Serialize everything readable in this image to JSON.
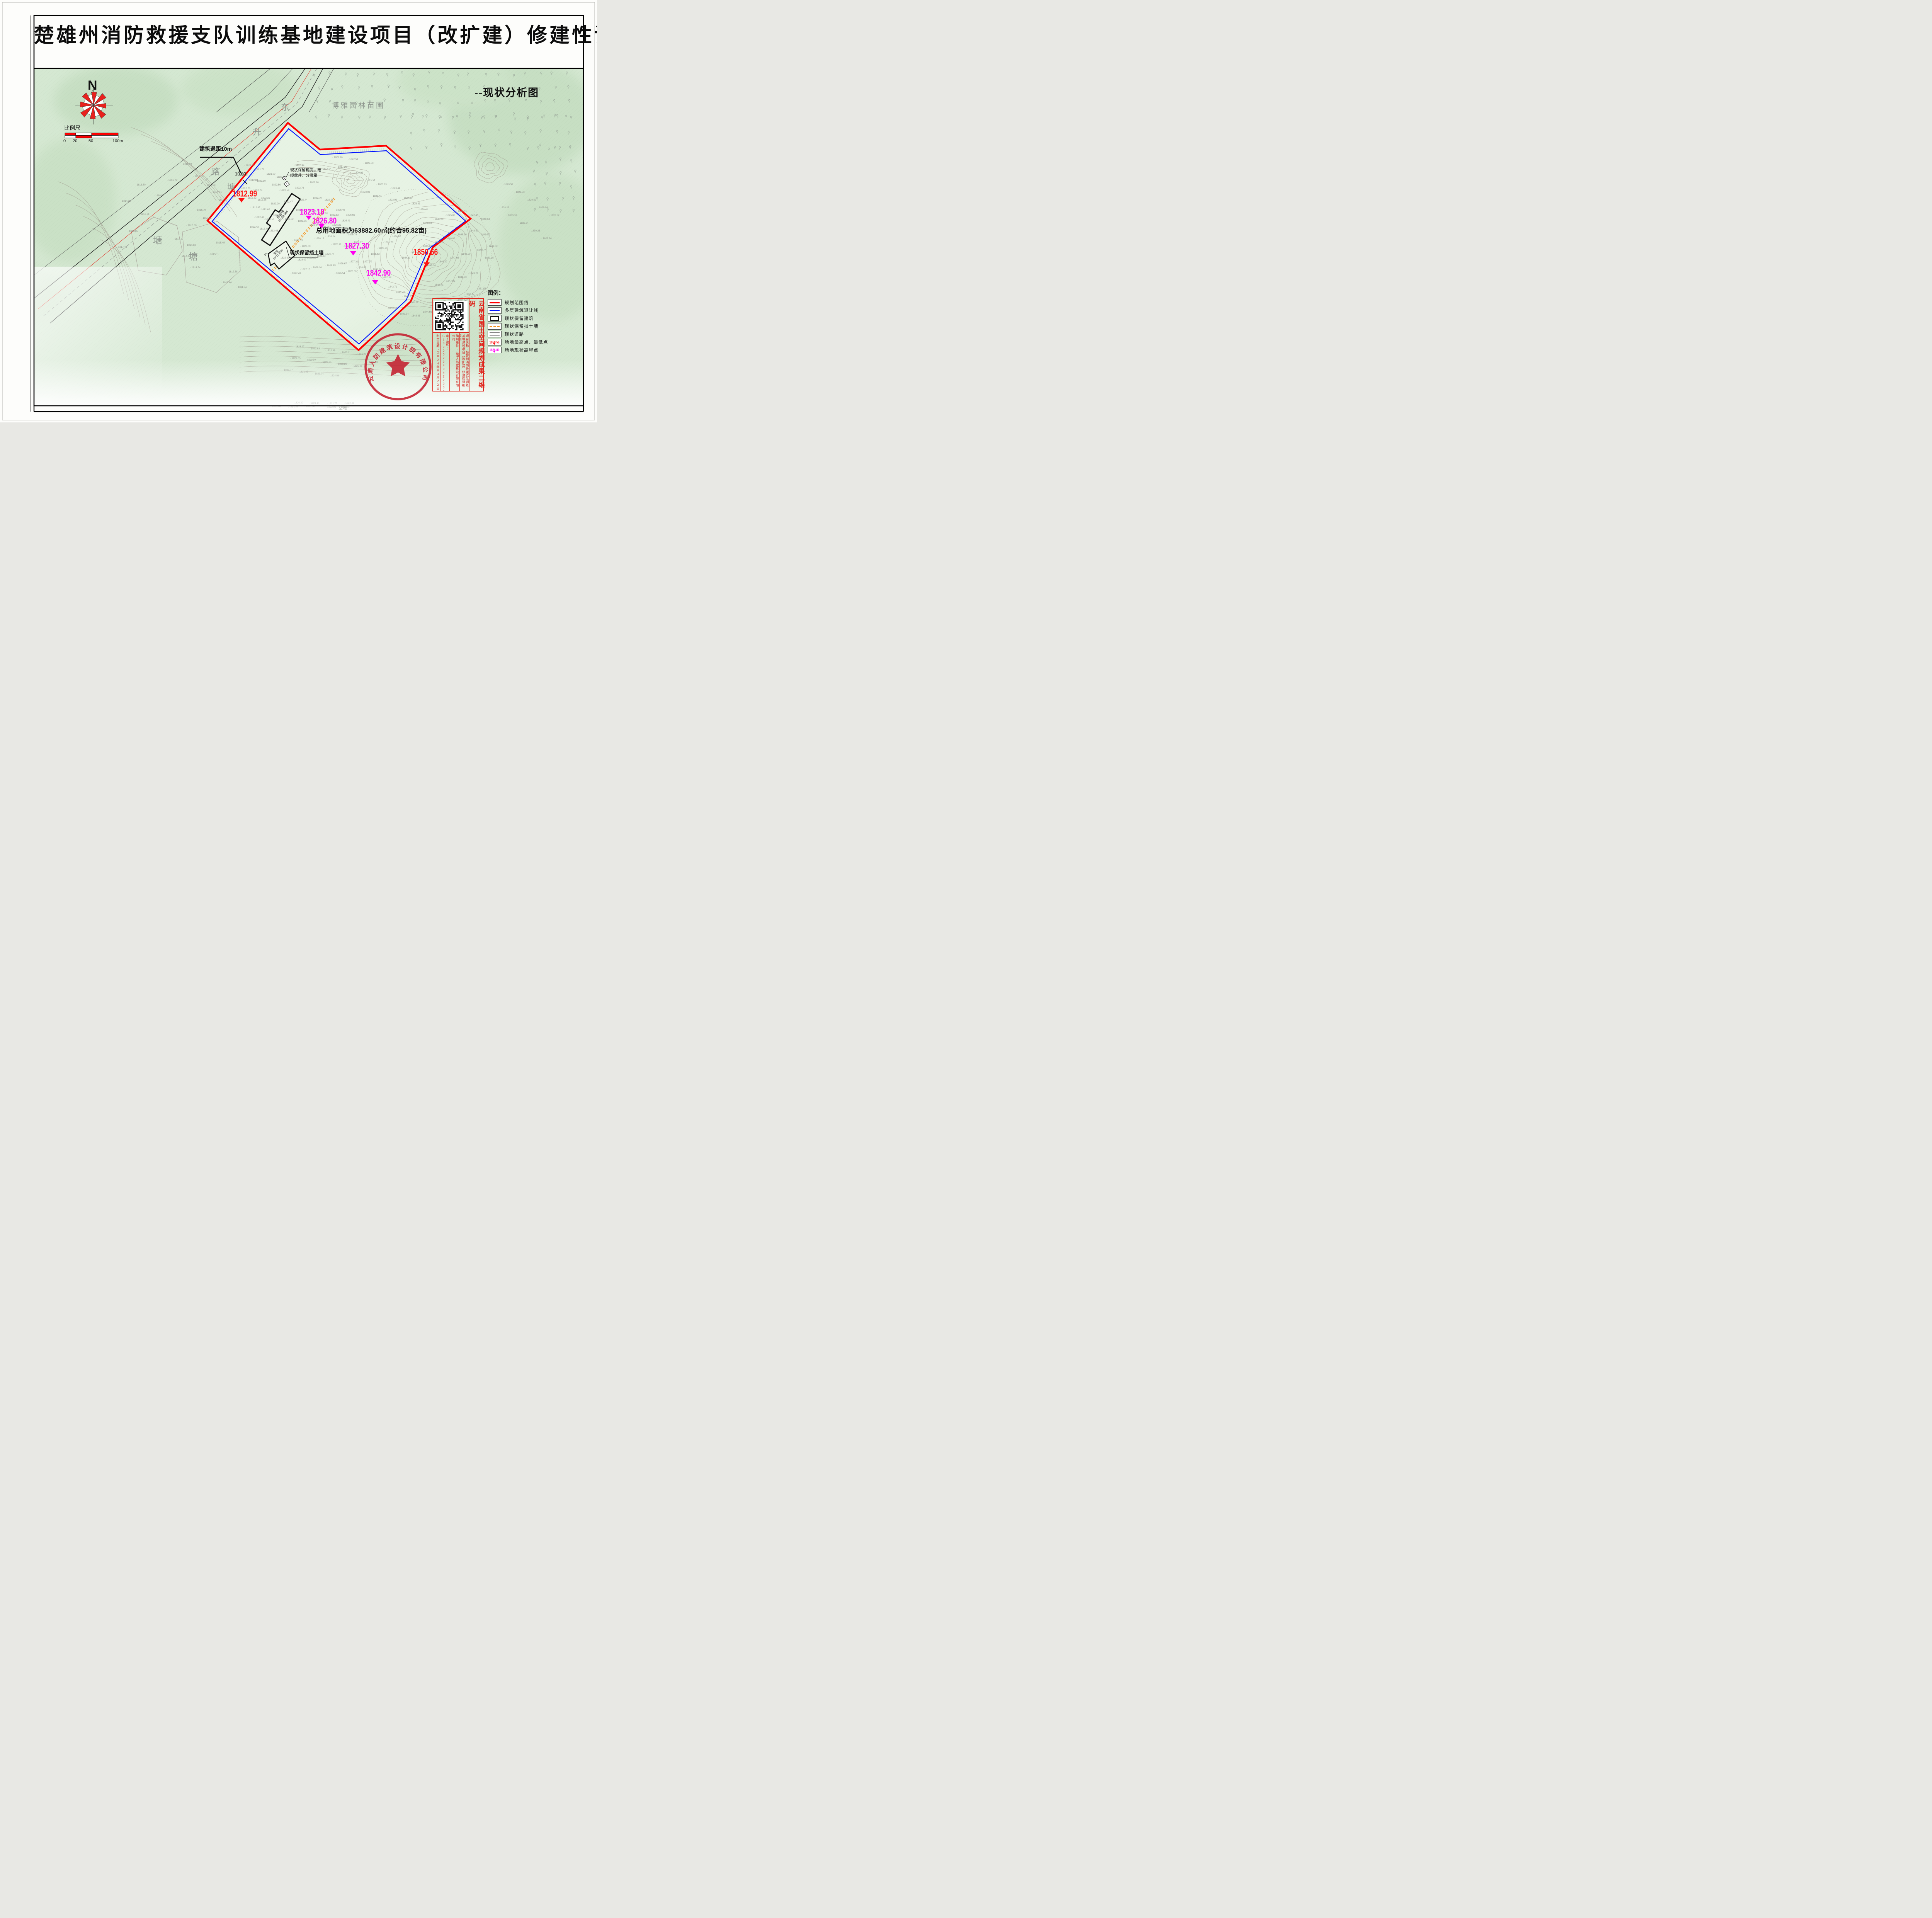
{
  "sheet": {
    "title": "楚雄州消防救援支队训练基地建设项目（改扩建）修建性详细规划",
    "subtitle": "--现状分析图"
  },
  "north": {
    "label": "N"
  },
  "scalebar": {
    "title": "比例尺",
    "ticks": [
      "0",
      "20",
      "50",
      "100m"
    ]
  },
  "map": {
    "road_chars": [
      "东",
      "升",
      "路"
    ],
    "nursery_label": "博雅园林苗圃",
    "pond_labels": [
      "塘",
      "塘",
      "塘"
    ],
    "vacant_label": "空地",
    "setback_note": "建筑退距10m",
    "setback_dim": "10.00",
    "utility_note_line1": "现状保留箱变、电",
    "utility_note_line2": "缆盘井、分接箱",
    "wall_note": "现状保留挡土墙",
    "area_note": "总用地面积为63882.60㎡(约合95.82亩)",
    "buildings": [
      {
        "name": "综合楼",
        "height": "H=28.5M",
        "floors": ""
      },
      {
        "name": "食堂",
        "height": "H=11.25M",
        "floors": "3F"
      }
    ],
    "key_points": [
      {
        "value": "1812.99",
        "kind": "extreme"
      },
      {
        "value": "1823.10",
        "kind": "spot"
      },
      {
        "value": "1826.80",
        "kind": "spot"
      },
      {
        "value": "1827.30",
        "kind": "spot"
      },
      {
        "value": "1842.90",
        "kind": "spot"
      },
      {
        "value": "1850.56",
        "kind": "extreme"
      }
    ],
    "spot_elevations": [
      [
        470,
        426,
        "1816.94"
      ],
      [
        432,
        468,
        "1816.73"
      ],
      [
        398,
        508,
        "1816.50"
      ],
      [
        500,
        458,
        "1817.05"
      ],
      [
        531,
        481,
        "1816.89"
      ],
      [
        547,
        500,
        "1817.33"
      ],
      [
        562,
        519,
        "1817.40"
      ],
      [
        506,
        545,
        "1816.79"
      ],
      [
        521,
        566,
        "1817.21"
      ],
      [
        482,
        585,
        "1816.60"
      ],
      [
        350,
        480,
        "1813.60"
      ],
      [
        312,
        522,
        "1814.29"
      ],
      [
        360,
        556,
        "1816.71"
      ],
      [
        330,
        600,
        "1813.65"
      ],
      [
        302,
        641,
        "1817.41"
      ],
      [
        614,
        455,
        "1813.09"
      ],
      [
        641,
        468,
        "1812.84"
      ],
      [
        621,
        489,
        "1812.70"
      ],
      [
        652,
        494,
        "1812.75"
      ],
      [
        637,
        514,
        "1812.62"
      ],
      [
        663,
        519,
        "1812.56"
      ],
      [
        647,
        539,
        "1812.47"
      ],
      [
        672,
        544,
        "1812.62"
      ],
      [
        657,
        564,
        "1812.43"
      ],
      [
        683,
        569,
        "1812.50"
      ],
      [
        643,
        589,
        "1812.42"
      ],
      [
        668,
        594,
        "1812.44"
      ],
      [
        693,
        599,
        "1812.46"
      ],
      [
        448,
        620,
        "1814.57"
      ],
      [
        480,
        636,
        "1814.53"
      ],
      [
        466,
        664,
        "1814.30"
      ],
      [
        492,
        694,
        "1814.54"
      ],
      [
        555,
        630,
        "1815.45"
      ],
      [
        540,
        660,
        "1815.11"
      ],
      [
        588,
        705,
        "1812.58"
      ],
      [
        573,
        733,
        "1812.66"
      ],
      [
        612,
        745,
        "1811.54"
      ],
      [
        661,
        470,
        "1822.19"
      ],
      [
        700,
        480,
        "1822.50"
      ],
      [
        722,
        494,
        "1822.58"
      ],
      [
        760,
        488,
        "1822.76"
      ],
      [
        798,
        474,
        "1822.80"
      ],
      [
        672,
        514,
        "1822.31"
      ],
      [
        697,
        529,
        "1822.20"
      ],
      [
        731,
        524,
        "1822.47"
      ],
      [
        769,
        519,
        "1822.44"
      ],
      [
        806,
        514,
        "1822.70"
      ],
      [
        836,
        519,
        "1822.78"
      ],
      [
        762,
        545,
        "1822.51"
      ],
      [
        792,
        549,
        "1822.86"
      ],
      [
        822,
        554,
        "1822.91"
      ],
      [
        850,
        558,
        "1822.82"
      ],
      [
        703,
        559,
        "1822.40"
      ],
      [
        733,
        569,
        "1822.52"
      ],
      [
        767,
        574,
        "1822.36"
      ],
      [
        797,
        584,
        "1823.04"
      ],
      [
        826,
        589,
        "1826.28"
      ],
      [
        856,
        584,
        "1826.35"
      ],
      [
        880,
        573,
        "1826.41"
      ],
      [
        866,
        545,
        "1826.49"
      ],
      [
        892,
        558,
        "1826.65"
      ],
      [
        871,
        604,
        "1826.64"
      ],
      [
        897,
        609,
        "1826.74"
      ],
      [
        841,
        614,
        "1826.24"
      ],
      [
        812,
        619,
        "1826.19"
      ],
      [
        857,
        634,
        "1826.71"
      ],
      [
        887,
        639,
        "1826.69"
      ],
      [
        912,
        629,
        "1826.77"
      ],
      [
        926,
        644,
        "1826.87"
      ],
      [
        757,
        624,
        "1822.75"
      ],
      [
        777,
        639,
        "1823.09"
      ],
      [
        746,
        654,
        "1822.43"
      ],
      [
        722,
        669,
        "1822.69"
      ],
      [
        766,
        674,
        "1823.07"
      ],
      [
        791,
        669,
        "1823.12"
      ],
      [
        816,
        664,
        "1826.53"
      ],
      [
        838,
        659,
        "1826.77"
      ],
      [
        900,
        679,
        "1827.31"
      ],
      [
        871,
        684,
        "1826.67"
      ],
      [
        842,
        689,
        "1826.65"
      ],
      [
        806,
        694,
        "1826.16"
      ],
      [
        776,
        699,
        "1827.10"
      ],
      [
        752,
        709,
        "1827.43"
      ],
      [
        866,
        709,
        "1826.54"
      ],
      [
        896,
        704,
        "1826.60"
      ],
      [
        921,
        694,
        "1826.69"
      ],
      [
        936,
        679,
        "1827.70"
      ],
      [
        956,
        659,
        "1826.62"
      ],
      [
        976,
        644,
        "1826.74"
      ],
      [
        991,
        629,
        "1826.78"
      ],
      [
        1011,
        614,
        "1826.87"
      ],
      [
        1031,
        599,
        "1826.85"
      ],
      [
        761,
        429,
        "1817.15"
      ],
      [
        792,
        444,
        "1816.86"
      ],
      [
        831,
        439,
        "1817.04"
      ],
      [
        871,
        434,
        "1817.25"
      ],
      [
        913,
        449,
        "1820.92"
      ],
      [
        944,
        469,
        "1823.35"
      ],
      [
        974,
        479,
        "1823.63"
      ],
      [
        1009,
        489,
        "1823.44"
      ],
      [
        931,
        499,
        "1823.03"
      ],
      [
        961,
        509,
        "1823.41"
      ],
      [
        1001,
        519,
        "1823.92"
      ],
      [
        1041,
        514,
        "1824.39"
      ],
      [
        1061,
        529,
        "1825.93"
      ],
      [
        1081,
        544,
        "1826.41"
      ],
      [
        961,
        699,
        "1831.28"
      ],
      [
        986,
        719,
        "1837.68"
      ],
      [
        1001,
        744,
        "1842.71"
      ],
      [
        1021,
        759,
        "1843.47"
      ],
      [
        1041,
        769,
        "1844.97"
      ],
      [
        1056,
        784,
        "1845.21"
      ],
      [
        1001,
        799,
        "1840.18"
      ],
      [
        1031,
        814,
        "1841.34"
      ],
      [
        1061,
        819,
        "1843.95"
      ],
      [
        1091,
        809,
        "1844.66"
      ],
      [
        1121,
        799,
        "1845.99"
      ],
      [
        1151,
        789,
        "1848.04"
      ],
      [
        1181,
        779,
        "1850.14"
      ],
      [
        1201,
        764,
        "1850.64"
      ],
      [
        1231,
        749,
        "1851.84"
      ],
      [
        1121,
        739,
        "1846.41"
      ],
      [
        1151,
        729,
        "1847.95"
      ],
      [
        1181,
        719,
        "1848.53"
      ],
      [
        1211,
        709,
        "1849.21"
      ],
      [
        1101,
        689,
        "1845.34"
      ],
      [
        1131,
        679,
        "1846.22"
      ],
      [
        1161,
        669,
        "1847.65"
      ],
      [
        1191,
        659,
        "1848.99"
      ],
      [
        1231,
        649,
        "1849.77"
      ],
      [
        1251,
        669,
        "1851.15"
      ],
      [
        1261,
        639,
        "1849.52"
      ],
      [
        1241,
        609,
        "1849.07"
      ],
      [
        1211,
        599,
        "1848.50"
      ],
      [
        1181,
        609,
        "1846.90"
      ],
      [
        1151,
        619,
        "1846.02"
      ],
      [
        1121,
        629,
        "1845.86"
      ],
      [
        1091,
        639,
        "1845.67"
      ],
      [
        1061,
        654,
        "1845.16"
      ],
      [
        1036,
        669,
        "1844.11"
      ],
      [
        1091,
        579,
        "1846.13"
      ],
      [
        1121,
        569,
        "1845.64"
      ],
      [
        1151,
        559,
        "1845.05"
      ],
      [
        1181,
        549,
        "1846.03"
      ],
      [
        1211,
        559,
        "1847.45"
      ],
      [
        1241,
        569,
        "1849.04"
      ],
      [
        1301,
        479,
        "1829.58"
      ],
      [
        1331,
        499,
        "1829.73"
      ],
      [
        1361,
        519,
        "1829.52"
      ],
      [
        1391,
        539,
        "1829.04"
      ],
      [
        1421,
        559,
        "1828.57"
      ],
      [
        1291,
        539,
        "1828.29"
      ],
      [
        1311,
        559,
        "1833.18"
      ],
      [
        1341,
        579,
        "1832.34"
      ],
      [
        1371,
        599,
        "1830.25"
      ],
      [
        1401,
        619,
        "1829.94"
      ],
      [
        761,
        899,
        "1823.27"
      ],
      [
        801,
        904,
        "1822.83"
      ],
      [
        841,
        909,
        "1822.68"
      ],
      [
        881,
        914,
        "1823.11"
      ],
      [
        921,
        919,
        "1823.71"
      ],
      [
        751,
        929,
        "1822.05"
      ],
      [
        791,
        934,
        "1822.27"
      ],
      [
        831,
        939,
        "1823.35"
      ],
      [
        871,
        944,
        "1823.26"
      ],
      [
        911,
        949,
        "1825.36"
      ],
      [
        951,
        939,
        "1824.23"
      ],
      [
        731,
        959,
        "1821.77"
      ],
      [
        771,
        964,
        "1821.05"
      ],
      [
        811,
        969,
        "1823.04"
      ],
      [
        851,
        974,
        "1824.04"
      ],
      [
        860,
        409,
        "1821.96"
      ],
      [
        900,
        414,
        "1822.59"
      ],
      [
        940,
        424,
        "1822.80"
      ],
      [
        657,
        440,
        "1821.71"
      ],
      [
        686,
        452,
        "1821.00"
      ],
      [
        712,
        460,
        "1822.04"
      ],
      [
        632,
        430,
        "1821.89"
      ]
    ],
    "margin_spots": [
      [
        700,
        1054,
        "1820.96"
      ],
      [
        745,
        1056,
        "1821.25"
      ],
      [
        788,
        1054,
        "1821.30"
      ],
      [
        843,
        1055,
        "1822.92"
      ],
      [
        878,
        1055,
        "1822.73"
      ],
      [
        758,
        1044,
        "1820.20"
      ],
      [
        800,
        1045,
        "1821.14"
      ],
      [
        846,
        1046,
        "1821.75"
      ],
      [
        890,
        1045,
        "1822.41"
      ]
    ]
  },
  "legend": {
    "title": "图例：",
    "items": [
      {
        "label": "规划范围线"
      },
      {
        "label": "多层建筑退让线"
      },
      {
        "label": "现状保留建筑"
      },
      {
        "label": "现状保留挡土墙"
      },
      {
        "label": "现状道路"
      },
      {
        "label": "场地最高点、最低点",
        "sample": "1850.56"
      },
      {
        "label": "场地现状高程点",
        "sample": "1826.80"
      }
    ]
  },
  "qr_panel": {
    "side_label": "云南省国土空间规划成果二维码",
    "fields": [
      "制章日期：2024年04月22日",
      "电子编号：G182002240422004[云]",
      "编制单位：云南人防建筑设计院有限公司",
      "项目名称：楚雄州消防救援支队训练基地建设项目（改扩建）修建性详细规划"
    ]
  },
  "stamp": {
    "company": "云南人防建筑设计院有限公司"
  },
  "colors": {
    "boundary": "#ff0000",
    "setback": "#0013ff",
    "wall": "#f6921e",
    "spot": "#ff00f0",
    "extreme": "#ff1414",
    "seal": "#c41f2f",
    "terrain": "#d5e8d2"
  }
}
